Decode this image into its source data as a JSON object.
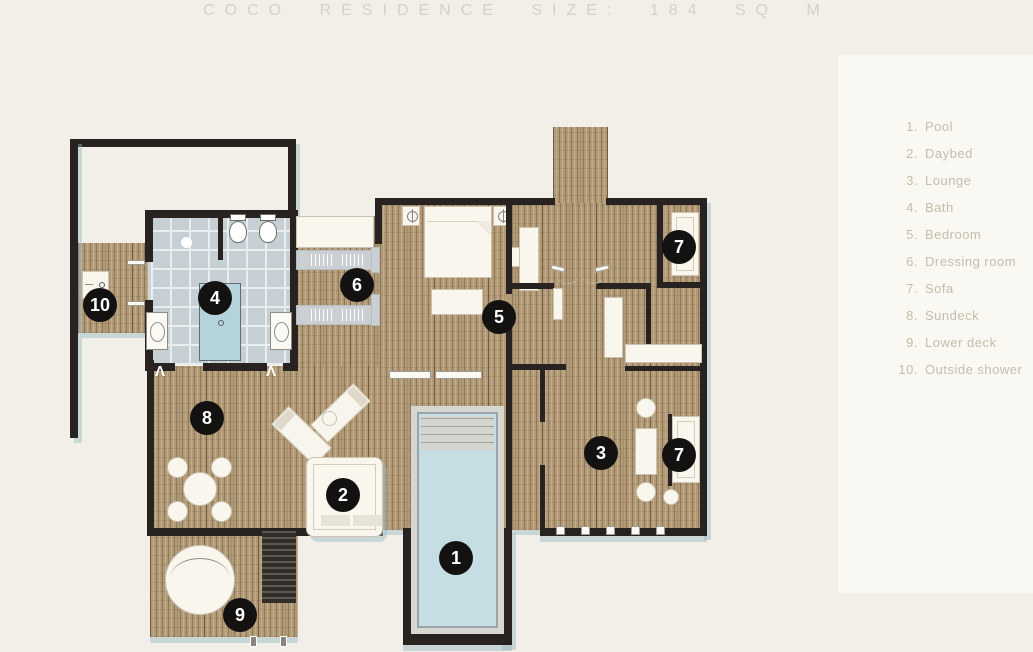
{
  "title": "COCO RESIDENCE SIZE: 184 SQ M",
  "legend": {
    "items": [
      {
        "num": "1.",
        "label": "Pool"
      },
      {
        "num": "2.",
        "label": "Daybed"
      },
      {
        "num": "3.",
        "label": "Lounge"
      },
      {
        "num": "4.",
        "label": "Bath"
      },
      {
        "num": "5.",
        "label": "Bedroom"
      },
      {
        "num": "6.",
        "label": "Dressing room"
      },
      {
        "num": "7.",
        "label": "Sofa"
      },
      {
        "num": "8.",
        "label": "Sundeck"
      },
      {
        "num": "9.",
        "label": "Lower deck"
      },
      {
        "num": "10.",
        "label": "Outside shower"
      }
    ]
  },
  "markers": {
    "pool": "1",
    "daybed": "2",
    "lounge": "3",
    "bath": "4",
    "bedroom": "5",
    "dressing_room": "6",
    "sofa_top": "7",
    "sofa_bottom": "7",
    "sundeck": "8",
    "lower_deck": "9",
    "outside_shower": "10"
  },
  "colors": {
    "background": "#f2efe8",
    "wood_deck": "#b29a77",
    "wall": "#282320",
    "bath_tile": "#c6cfd4",
    "pool_water": "#c5dde3",
    "bathtub": "#b5d3da",
    "marker_badge": "#141211",
    "title_text": "#d9d0c5",
    "legend_text": "#c7bcaa",
    "shadow": "#9db7c1"
  }
}
